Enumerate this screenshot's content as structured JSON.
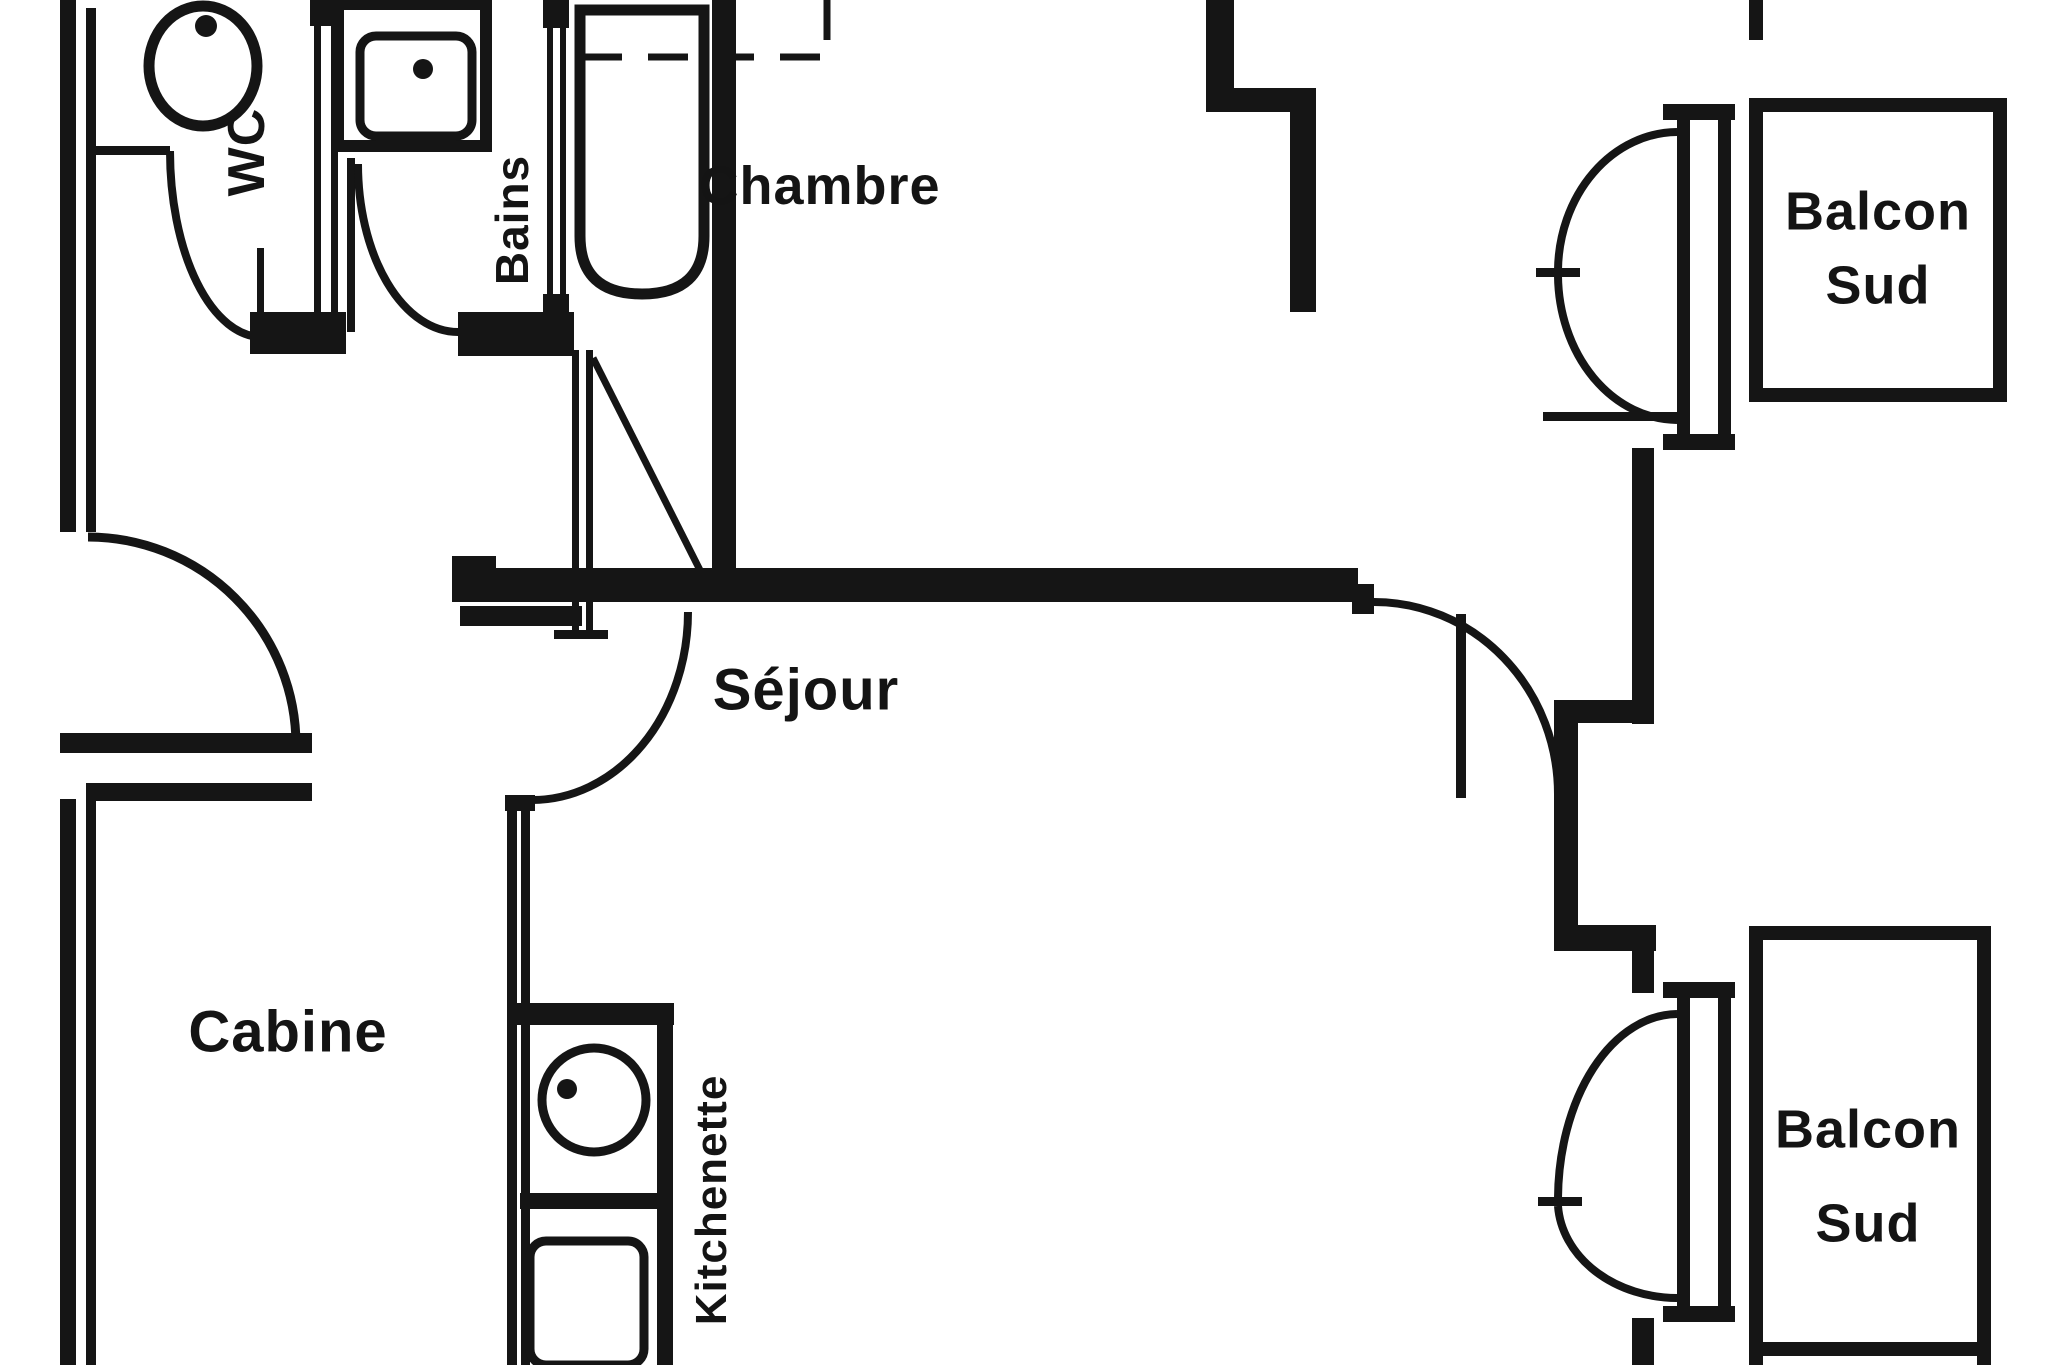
{
  "document": {
    "type": "apartment-floor-plan",
    "style": "black-and-white scanned architectural drawing"
  },
  "colors": {
    "wall": "#151515",
    "background": "#ffffff",
    "text": "#141414"
  },
  "rooms": {
    "wc": {
      "label": "WC"
    },
    "bains": {
      "label": "Bains"
    },
    "chambre": {
      "label": "Chambre"
    },
    "cabine": {
      "label": "Cabine"
    },
    "sejour": {
      "label": "Séjour"
    },
    "kitchenette": {
      "label": "Kitchenette"
    },
    "balcon_top": {
      "line1": "Balcon",
      "line2": "Sud"
    },
    "balcon_bottom": {
      "line1": "Balcon",
      "line2": "Sud"
    }
  },
  "fixtures": [
    "toilet",
    "washbasin",
    "bathtub",
    "kitchen-sink",
    "stove",
    "overhead-closet-dashed"
  ]
}
